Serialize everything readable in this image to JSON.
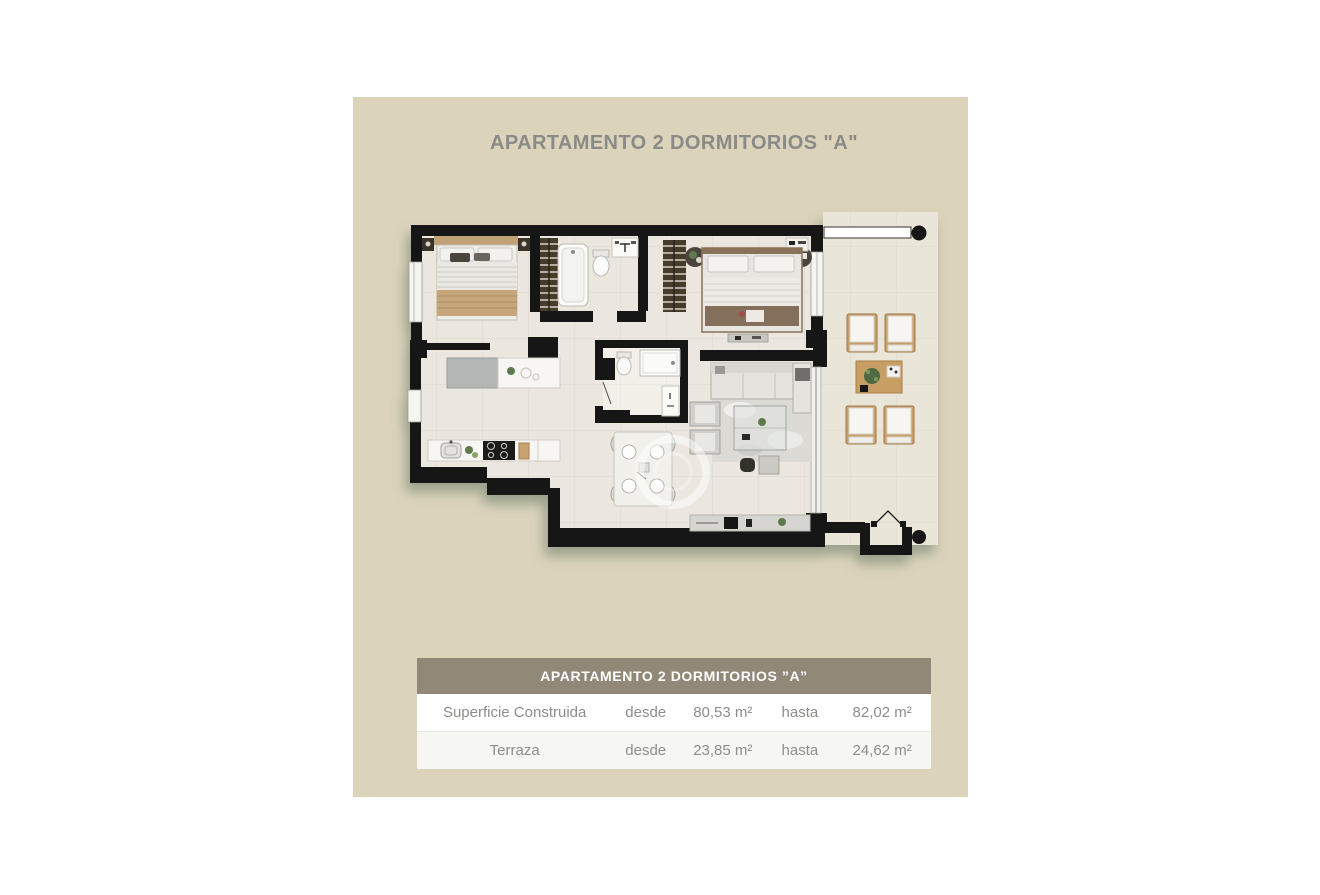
{
  "title": "APARTAMENTO 2 DORMITORIOS \"A\"",
  "table": {
    "header": "APARTAMENTO 2 DORMITORIOS ”A”",
    "rows": [
      {
        "label": "Superficie Construida",
        "from_label": "desde",
        "from_value": "80,53 m²",
        "to_label": "hasta",
        "to_value": "82,02 m²"
      },
      {
        "label": "Terraza",
        "from_label": "desde",
        "from_value": "23,85 m²",
        "to_label": "hasta",
        "to_value": "24,62 m²"
      }
    ]
  },
  "colors": {
    "panel_bg": "#dbd4ba",
    "table_header_bg": "#918878",
    "table_header_text": "#ffffff",
    "row_text": "#8f8d89",
    "title_text": "#8a8a88",
    "wall": "#181512",
    "floor": "#ebe7de",
    "terrace_floor": "#e9e5d8",
    "wood": "#c79e63",
    "plan_shadow": "#647468"
  },
  "floor_plan": {
    "areas": [
      "bedroom-1",
      "bathroom-1",
      "hall",
      "bedroom-2",
      "bathroom-2",
      "kitchen",
      "dining-area",
      "living-room",
      "terrace",
      "entrance"
    ]
  }
}
